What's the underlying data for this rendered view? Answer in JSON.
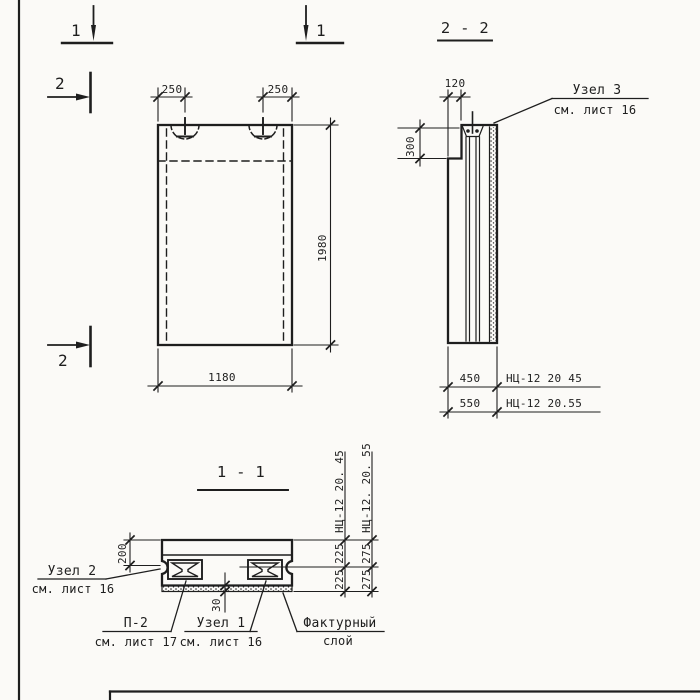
{
  "sheet": {
    "ink_color": "#1e1e1e",
    "paper_color": "#fbfaf7"
  },
  "markers": {
    "sec1_left": "1",
    "sec1_right": "1",
    "sec2_top": "2",
    "sec2_bottom": "2"
  },
  "front_view": {
    "dim_250_left": "250",
    "dim_250_right": "250",
    "dim_height": "1980",
    "dim_width": "1180"
  },
  "section22": {
    "title": "2 - 2",
    "dim_top": "120",
    "dim_left": "300",
    "row_a": {
      "dim": "450",
      "label": "НЦ-12 20 45"
    },
    "row_b": {
      "dim": "550",
      "label": "НЦ-12 20.55"
    },
    "callout_node3": {
      "line1": "Узел 3",
      "line2": "см. лист 16"
    }
  },
  "section11": {
    "title": "1 - 1",
    "dim_left": "200",
    "dim_facing": "30",
    "col_a": {
      "label": "НЦ-12 20. 45",
      "dims": [
        "225",
        "225"
      ]
    },
    "col_b": {
      "label": "НЦ-12. 20. 55",
      "dims": [
        "275",
        "275"
      ]
    },
    "callout_node2": {
      "line1": "Узел 2",
      "line2": "см. лист 16"
    },
    "callout_p2": {
      "line1": "П-2",
      "line2": "см. лист 17"
    },
    "callout_node1": {
      "line1": "Узел 1",
      "line2": "см. лист 16"
    },
    "callout_facing": {
      "line1": "Фактурный",
      "line2": "слой"
    }
  }
}
